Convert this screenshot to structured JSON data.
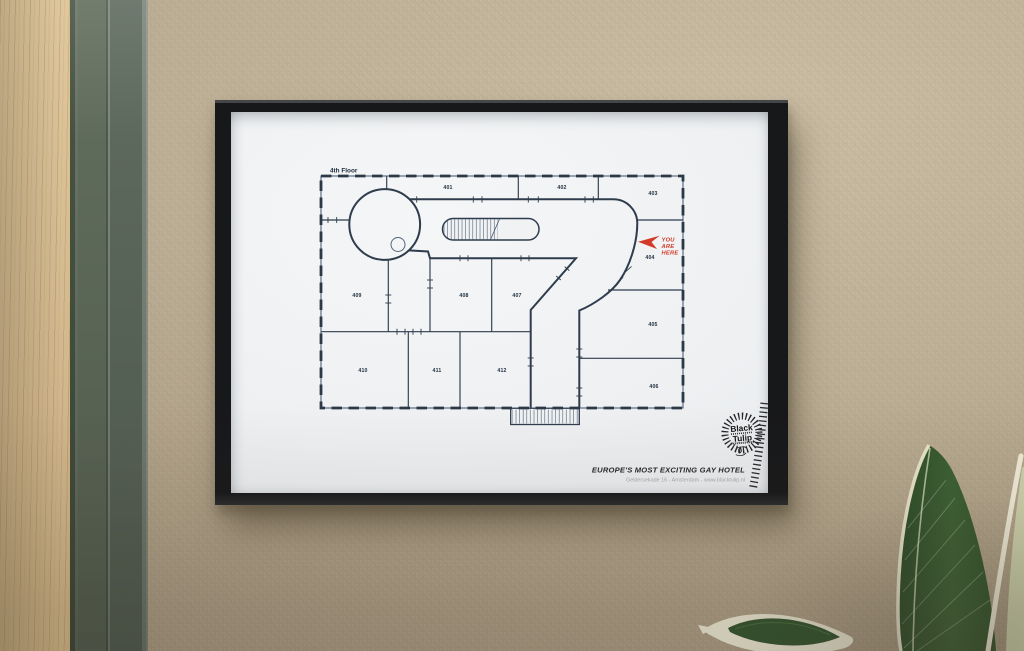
{
  "scene": {
    "wall_color": "#b7a78e",
    "door_wood_color": "#d6bd92",
    "door_frame_color": "#5f6b5a",
    "picture_frame_color": "#17181a",
    "paper_color": "#eef0f2",
    "plan_line_color": "#2e3c4d",
    "leaf_green": "#33512c",
    "leaf_cream": "#e8e5d0"
  },
  "poster": {
    "floor_label": "4th Floor",
    "rooms": [
      {
        "label": "401"
      },
      {
        "label": "402"
      },
      {
        "label": "403"
      },
      {
        "label": "404"
      },
      {
        "label": "405"
      },
      {
        "label": "406"
      },
      {
        "label": "407"
      },
      {
        "label": "408"
      },
      {
        "label": "409"
      },
      {
        "label": "410"
      },
      {
        "label": "411"
      },
      {
        "label": "412"
      }
    ],
    "marker": {
      "color": "#d43a28",
      "lines": [
        "YOU",
        "ARE",
        "HERE"
      ]
    },
    "logo": {
      "line1": "Black",
      "line2": "Tulip"
    },
    "tagline": "EUROPE'S MOST EXCITING GAY HOTEL",
    "address": "Geldersekade 16 - Amsterdam - www.blacktulip.nl"
  }
}
